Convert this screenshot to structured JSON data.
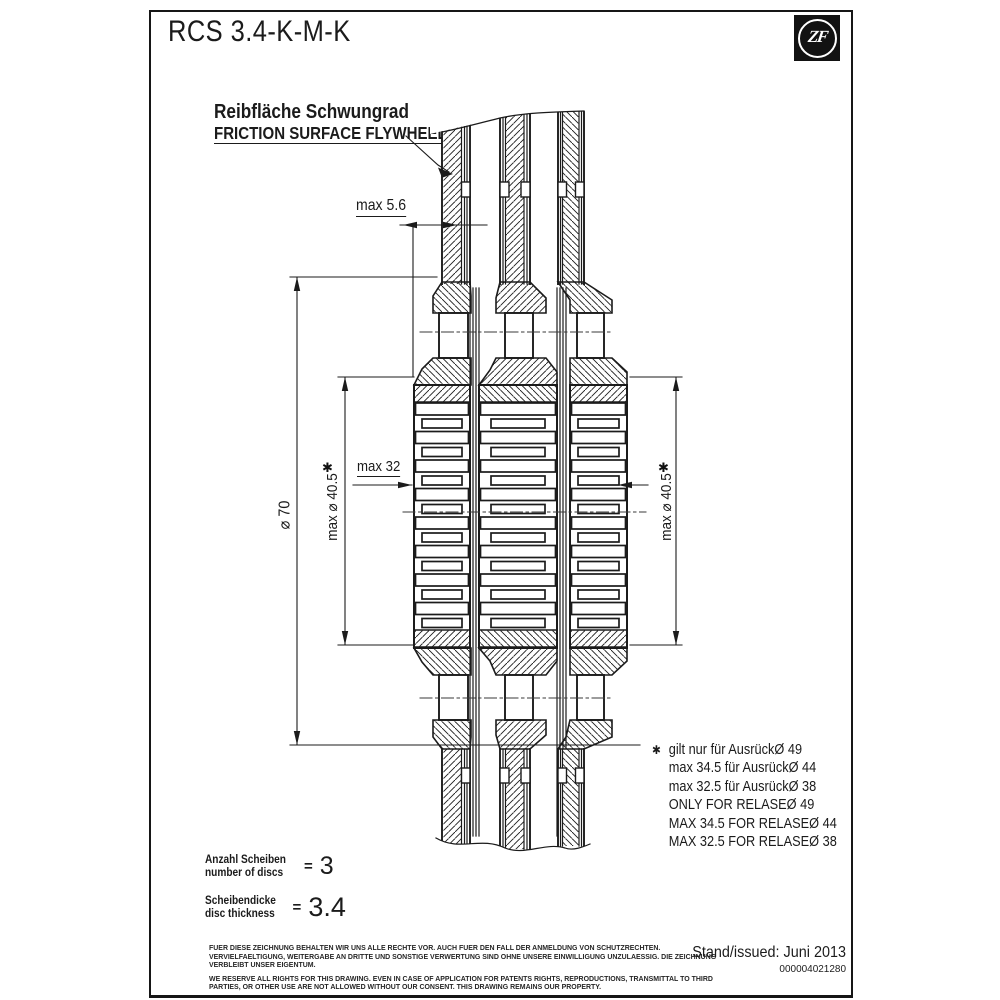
{
  "title": "RCS 3.4-K-M-K",
  "logo": {
    "text": "ZF"
  },
  "labels": {
    "friction_surface_de": "Reibfläche Schwungrad",
    "friction_surface_en": "FRICTION SURFACE FLYWHEEL"
  },
  "dimensions": {
    "max_5_6": "max 5.6",
    "dia_70": "⌀ 70",
    "max_dia_40_5": "max ⌀ 40.5",
    "max_32": "max 32",
    "asterisk": "✱"
  },
  "notes": {
    "marker": "✱",
    "lines": [
      "gilt nur für AusrückØ 49",
      "max 34.5 für AusrückØ 44",
      "max 32.5 für AusrückØ 38",
      "ONLY FOR RELASEØ 49",
      "MAX 34.5 FOR RELASEØ 44",
      "MAX 32.5 FOR RELASEØ 38"
    ]
  },
  "specs": {
    "discs_label_de": "Anzahl Scheiben",
    "discs_label_en": "number of discs",
    "discs_equals": "=",
    "discs_value": "3",
    "thickness_label_de": "Scheibendicke",
    "thickness_label_en": "disc thickness",
    "thickness_equals": "=",
    "thickness_value": "3.4"
  },
  "legal": {
    "de": "FUER DIESE ZEICHNUNG BEHALTEN WIR UNS ALLE RECHTE VOR. AUCH FUER DEN FALL DER ANMELDUNG VON SCHUTZRECHTEN. VERVIELFAELTIGUNG, WEITERGABE AN DRITTE UND SONSTIGE VERWERTUNG SIND OHNE UNSERE EINWILLIGUNG UNZULAESSIG. DIE ZEICHNUNG VERBLEIBT UNSER EIGENTUM.",
    "en": "WE RESERVE ALL RIGHTS FOR THIS DRAWING. EVEN IN CASE OF APPLICATION FOR PATENTS RIGHTS, REPRODUCTIONS, TRANSMITTAL TO THIRD PARTIES, OR OTHER USE ARE NOT ALLOWED WITHOUT OUR CONSENT. THIS DRAWING REMAINS OUR PROPERTY."
  },
  "issue": {
    "label": "Stand/issued: Juni 2013",
    "number": "000004021280"
  },
  "colors": {
    "ink": "#1b1b1b",
    "background": "#ffffff"
  }
}
